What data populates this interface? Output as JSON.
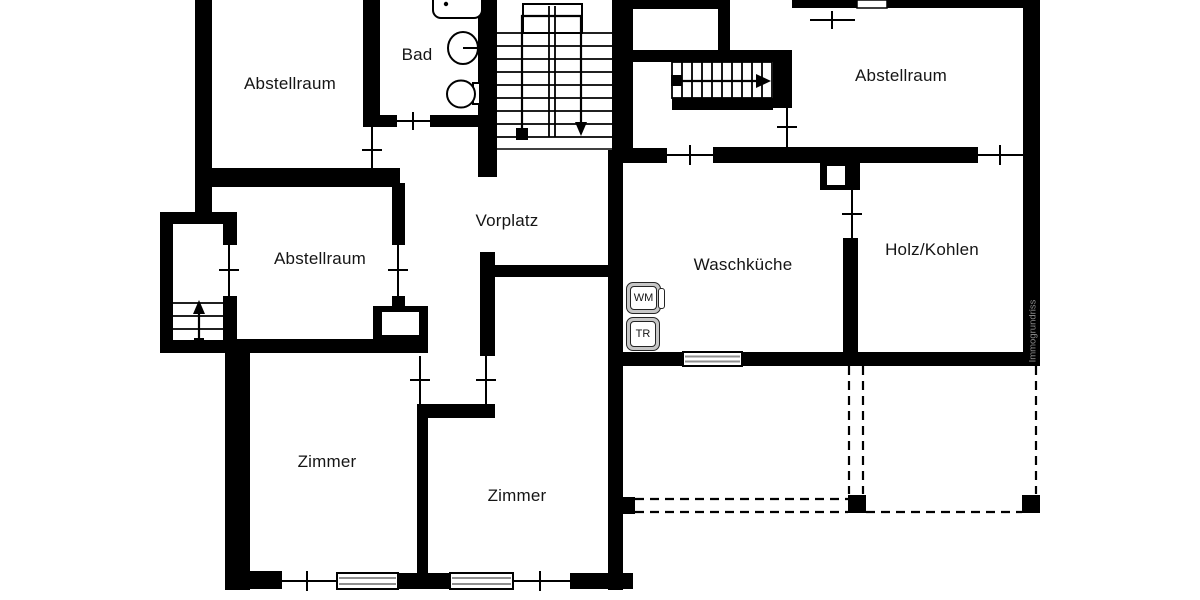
{
  "labels": {
    "abstellraum_top_left": "Abstellraum",
    "bad": "Bad",
    "abstellraum_top_right": "Abstellraum",
    "abstellraum_mid_left": "Abstellraum",
    "vorplatz": "Vorplatz",
    "waschkueche": "Waschküche",
    "holz_kohlen": "Holz/Kohlen",
    "zimmer_bottom_left": "Zimmer",
    "zimmer_bottom_middle": "Zimmer",
    "wm": "WM",
    "tr": "TR"
  },
  "watermark": "Immogrundriss",
  "icons": {
    "stair_u_run": "double-run staircase with down arrow",
    "stair_entrance_run": "single-run staircase with right arrow",
    "stair_exterior": "exterior steps with up arrow",
    "bathtub": "bathtub outline",
    "sink": "round washbasin",
    "toilet": "toilet with cistern",
    "window": "striped window symbol",
    "door_tick": "door opening marker"
  },
  "colors": {
    "wall": "#000000",
    "background": "#ffffff",
    "appliance_frame": "#c6c6c6",
    "window_stripe": "#8f8f8f",
    "watermark": "#8c8c8c"
  }
}
